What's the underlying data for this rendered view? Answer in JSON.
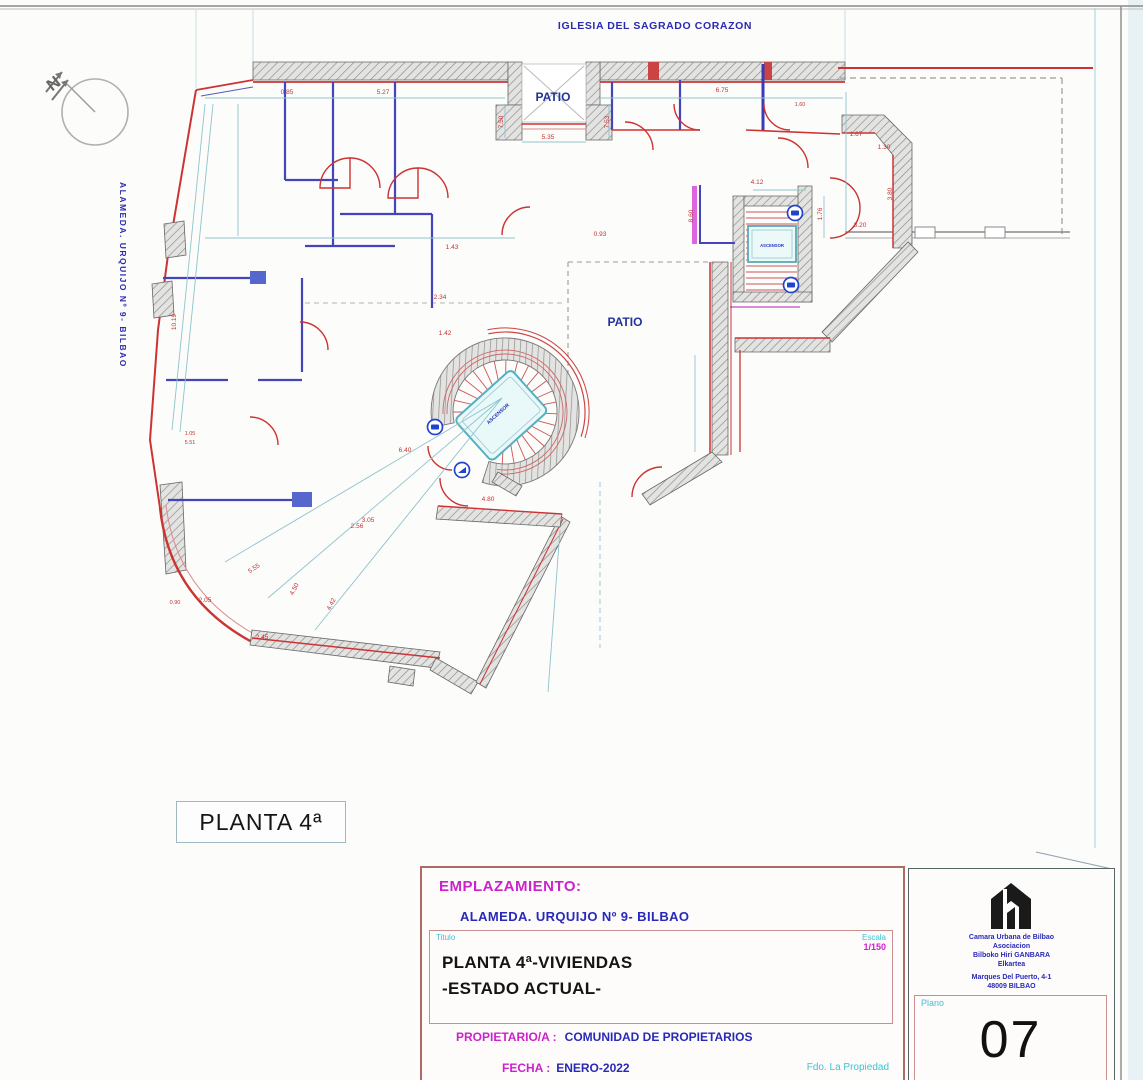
{
  "sheet": {
    "top_label": "IGLESIA DEL SAGRADO CORAZON",
    "street_label": "ALAMEDA. URQUIJO Nº 9- BILBAO",
    "floor_box_label": "PLANTA 4ª"
  },
  "plan": {
    "labels": [
      {
        "x": 553,
        "y": 101,
        "t": "PATIO",
        "s": 12,
        "c": "#223399",
        "w": "bold",
        "n": "patio-top-label"
      },
      {
        "x": 625,
        "y": 326,
        "t": "PATIO",
        "s": 12,
        "c": "#223399",
        "w": "bold",
        "n": "patio-center-label"
      },
      {
        "x": 772,
        "y": 247,
        "t": "ASCENSOR",
        "s": 4.2,
        "c": "#2233bb",
        "w": "bold",
        "n": "elevator-label"
      },
      {
        "x": 499,
        "y": 415,
        "t": "ASCENSOR",
        "s": 5,
        "c": "#2233bb",
        "w": "bold",
        "r": -42,
        "n": "elevator-label"
      },
      {
        "x": 57,
        "y": 88,
        "t": "N",
        "s": 17,
        "c": "#666666",
        "w": "bold",
        "r": -38,
        "n": "north-letter"
      },
      {
        "x": 287,
        "y": 94,
        "t": "0.85"
      },
      {
        "x": 383,
        "y": 94,
        "t": "5.27"
      },
      {
        "x": 722,
        "y": 92,
        "t": "6.75"
      },
      {
        "x": 800,
        "y": 106,
        "t": "1.60",
        "s": 5.5
      },
      {
        "x": 548,
        "y": 139,
        "t": "5.35"
      },
      {
        "x": 503,
        "y": 122,
        "t": "7.50",
        "r": -90
      },
      {
        "x": 609,
        "y": 122,
        "t": "7.53",
        "r": -90
      },
      {
        "x": 757,
        "y": 184,
        "t": "4.12"
      },
      {
        "x": 693,
        "y": 216,
        "t": "8.60",
        "r": -90
      },
      {
        "x": 600,
        "y": 236,
        "t": "0.93"
      },
      {
        "x": 452,
        "y": 249,
        "t": "1.43"
      },
      {
        "x": 440,
        "y": 299,
        "t": "2.34"
      },
      {
        "x": 445,
        "y": 335,
        "t": "1.42"
      },
      {
        "x": 176,
        "y": 322,
        "t": "10.19",
        "r": -90
      },
      {
        "x": 856,
        "y": 136,
        "t": "1.67"
      },
      {
        "x": 884,
        "y": 149,
        "t": "1.30"
      },
      {
        "x": 892,
        "y": 194,
        "t": "3.80",
        "r": -90
      },
      {
        "x": 860,
        "y": 227,
        "t": "3.20"
      },
      {
        "x": 822,
        "y": 214,
        "t": "1.76",
        "r": -90
      },
      {
        "x": 405,
        "y": 452,
        "t": "6.40"
      },
      {
        "x": 368,
        "y": 522,
        "t": "3.05"
      },
      {
        "x": 488,
        "y": 501,
        "t": "4.80"
      },
      {
        "x": 357,
        "y": 528,
        "t": "2.56"
      },
      {
        "x": 255,
        "y": 570,
        "t": "5.55",
        "r": -33
      },
      {
        "x": 296,
        "y": 590,
        "t": "4.50",
        "r": -63
      },
      {
        "x": 333,
        "y": 605,
        "t": "4.42",
        "r": -63
      },
      {
        "x": 205,
        "y": 602,
        "t": "2.05"
      },
      {
        "x": 175,
        "y": 604,
        "t": "0.90",
        "s": 5.5
      },
      {
        "x": 262,
        "y": 639,
        "t": "2.45"
      },
      {
        "x": 190,
        "y": 435,
        "t": "1.05",
        "s": 5.5
      },
      {
        "x": 190,
        "y": 444,
        "t": "5.51",
        "s": 5.5
      }
    ]
  },
  "title_block": {
    "emplazamiento_label": "EMPLAZAMIENTO:",
    "address": "ALAMEDA. URQUIJO Nº 9- BILBAO",
    "titulo_label": "Titulo",
    "escala_label": "Escala",
    "escala_value": "1/150",
    "title_line1": "PLANTA 4ª-VIVIENDAS",
    "title_line2": "-ESTADO ACTUAL-",
    "owner_label": "PROPIETARIO/A :",
    "owner_value": "COMUNIDAD DE PROPIETARIOS",
    "date_label": "FECHA :",
    "date_value": "ENERO-2022",
    "signature_label": "Fdo. La Propiedad"
  },
  "logo_panel": {
    "org_lines": [
      "Camara Urbana de Bilbao",
      "Asociacion",
      "Bilboko Hiri GANBARA",
      "Elkartea"
    ],
    "address_lines": [
      "Marques Del Puerto, 4-1",
      "48009 BILBAO"
    ],
    "plano_label": "Plano",
    "plano_number": "07"
  }
}
